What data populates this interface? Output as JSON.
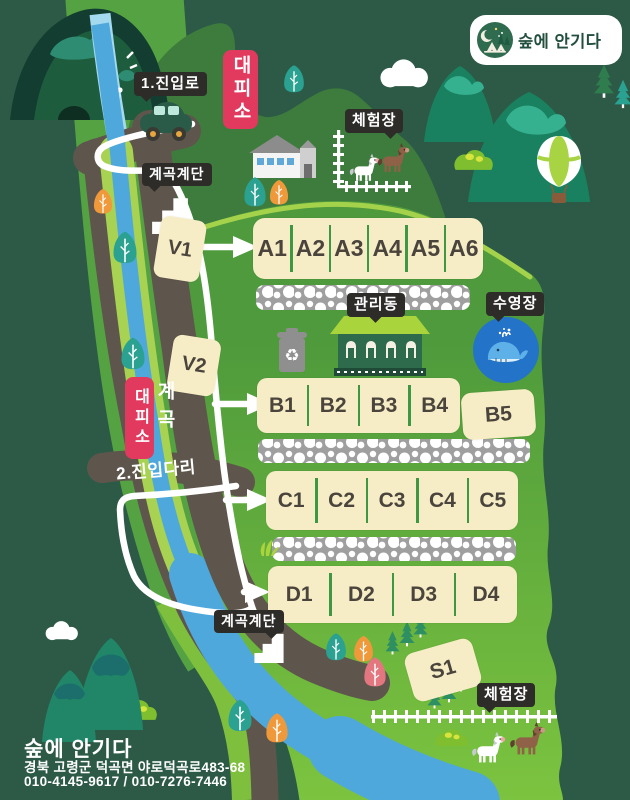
{
  "logo": {
    "title": "숲에 안기다"
  },
  "labels": {
    "entrance_road": "1.진입로",
    "shelter_top": "대피소",
    "experience_top": "체험장",
    "stairs_top": "계곡계단",
    "management": "관리동",
    "pool": "수영장",
    "shelter_mid": "대피소",
    "valley": "계곡",
    "bridge": "2.진입다리",
    "stairs_bottom": "계곡계단",
    "experience_bottom": "체험장"
  },
  "sites": {
    "v1": "V1",
    "v2": "V2",
    "s1": "S1",
    "b5": "B5",
    "row_a": [
      "A1",
      "A2",
      "A3",
      "A4",
      "A5",
      "A6"
    ],
    "row_b": [
      "B1",
      "B2",
      "B3",
      "B4"
    ],
    "row_c": [
      "C1",
      "C2",
      "C3",
      "C4",
      "C5"
    ],
    "row_d": [
      "D1",
      "D2",
      "D3",
      "D4"
    ]
  },
  "footer": {
    "title": "숲에 안기다",
    "address": "경북 고령군 덕곡면 야로덕곡로483-68",
    "phone": "010-4145-9617 / 010-7276-7446"
  },
  "colors": {
    "background": "#2C5A46",
    "camp_green": "#6FBC3E",
    "hill_green": "#3E7C3E",
    "road": "#5E564C",
    "river": "#4FA8DC",
    "site_box": "#F6EDC6",
    "divider_green": "#3E9742",
    "shelter_red": "#E23A5E",
    "label_black": "#2E2C29",
    "pool_blue": "#2373C8"
  }
}
